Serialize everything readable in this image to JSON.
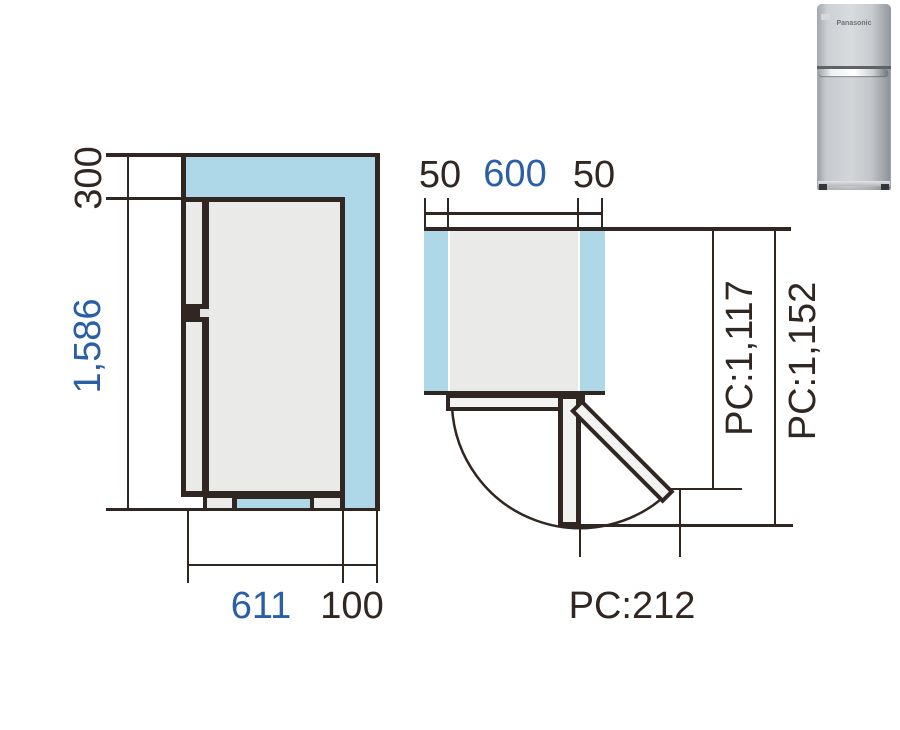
{
  "title": "Refrigerator installation dimensions diagram",
  "colors": {
    "line_dark": "#312722",
    "accent_blue": "#2a5ea6",
    "clearance_blue": "#aed7e8",
    "body_gray": "#eaeae8",
    "door_light": "#f2f2f0"
  },
  "side_view": {
    "top_clearance_label": "300",
    "height_label": "1,586",
    "depth_label": "611",
    "rear_clearance_label": "100"
  },
  "top_view": {
    "left_clearance_label": "50",
    "width_label": "600",
    "right_clearance_label": "50",
    "pc_dim_inner_label": "PC:1,117",
    "pc_dim_outer_label": "PC:1,152",
    "pc_dim_bottom_label": "PC:212"
  },
  "product_image": {
    "brand_label": "Panasonic"
  }
}
